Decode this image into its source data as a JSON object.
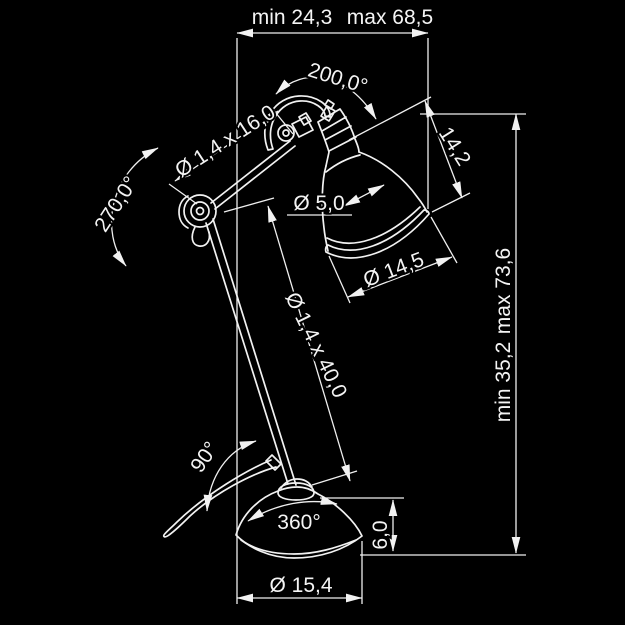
{
  "page": {
    "background": "#000000",
    "line_color": "#f2f2f2"
  },
  "labels": {
    "width_min": "min 24,3",
    "width_max": "max 68,5",
    "head_angle": "200,0°",
    "upper_arm_tube": "Ø 1,4 x 16,0",
    "elbow_angle": "270,0°",
    "socket_diameter": "Ø 5,0",
    "shade_depth": "14,2",
    "shade_diameter": "Ø 14,5",
    "lower_arm_tube": "Ø 1,4 x 40,0",
    "height_max": "max 73,6",
    "height_min": "min 35,2",
    "arm_pivot_angle": "90°",
    "base_rotation": "360°",
    "base_height": "6,0",
    "base_diameter": "Ø 15,4"
  }
}
